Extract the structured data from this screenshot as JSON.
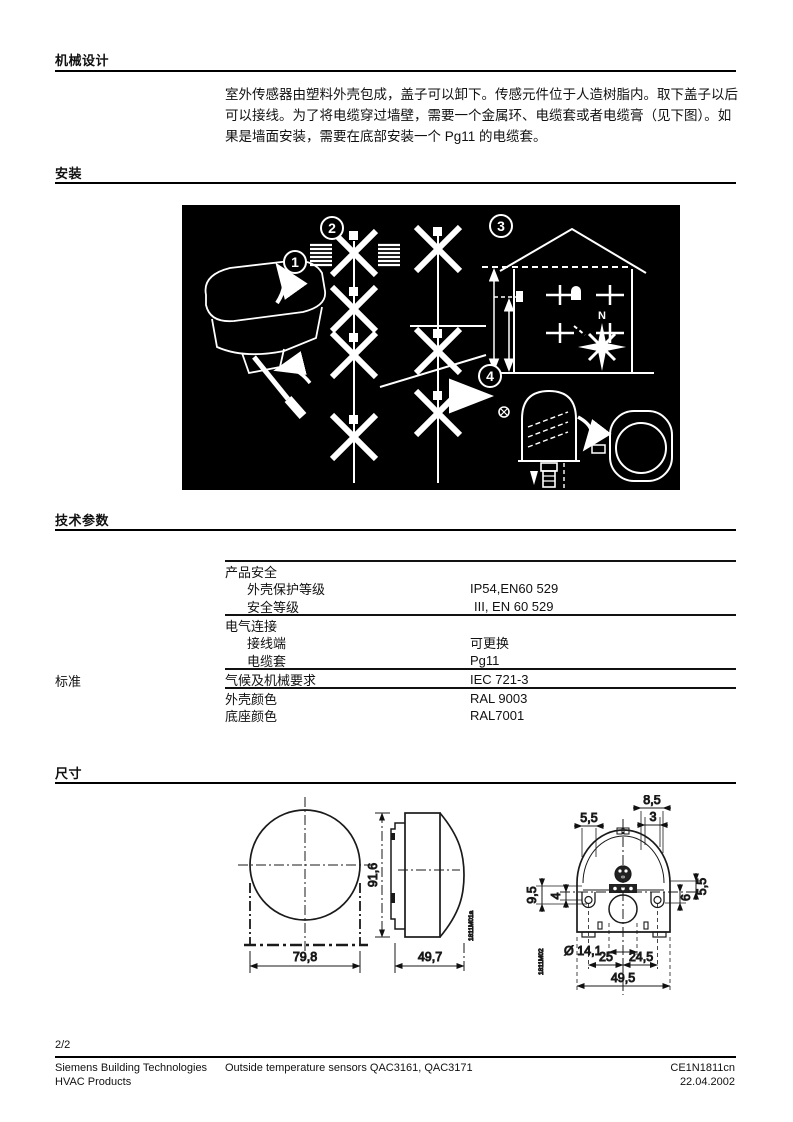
{
  "sections": {
    "mechanical": {
      "heading": "机械设计",
      "lines": [
        "室外传感器由塑料外壳包成，盖子可以卸下。传感元件位于人造树脂内。取下盖子以后",
        "可以接线。为了将电缆穿过墙壁，需要一个金属环、电缆套或者电缆膏（见下图）。如",
        "果是墙面安装，需要在底部安装一个 Pg11 的电缆套。"
      ]
    },
    "installation": {
      "heading": "安装",
      "steps": [
        "1",
        "2",
        "3",
        "4"
      ],
      "compass_north": "N"
    },
    "tech": {
      "heading": "技术参数",
      "side_label": "标准",
      "rows": [
        {
          "label": "产品安全",
          "value": ""
        },
        {
          "label": "外壳保护等级",
          "value": "IP54,EN60 529"
        },
        {
          "label": "安全等级",
          "value": "III, EN 60 529"
        },
        {
          "label": "电气连接",
          "value": ""
        },
        {
          "label": "接线端",
          "value": "可更换"
        },
        {
          "label": "电缆套",
          "value": "Pg11"
        },
        {
          "label": "气候及机械要求",
          "value": "IEC 721-3"
        },
        {
          "label": "外壳颜色",
          "value": "RAL 9003"
        },
        {
          "label": "底座颜色",
          "value": "RAL7001"
        }
      ]
    },
    "dims": {
      "heading": "尺寸",
      "front": {
        "width": "79,8",
        "height": "91,6"
      },
      "side": {
        "depth": "49,7",
        "code": "1811M01a"
      },
      "rear": {
        "top_85": "8,5",
        "top_3": "3",
        "top_55": "5,5",
        "left_95": "9,5",
        "left_4": "4",
        "right_6": "6",
        "right_55": "5,5",
        "hole": "Ø 14,1",
        "bot_25": "25",
        "bot_245": "24,5",
        "bot_495": "49,5",
        "code": "1811M02"
      }
    }
  },
  "footer": {
    "page_num": "2/2",
    "company_line1": "Siemens Building Technologies",
    "company_line2": "HVAC Products",
    "doc_title": "Outside temperature sensors QAC3161, QAC3171",
    "doc_code": "CE1N1811cn",
    "doc_date": "22.04.2002"
  }
}
